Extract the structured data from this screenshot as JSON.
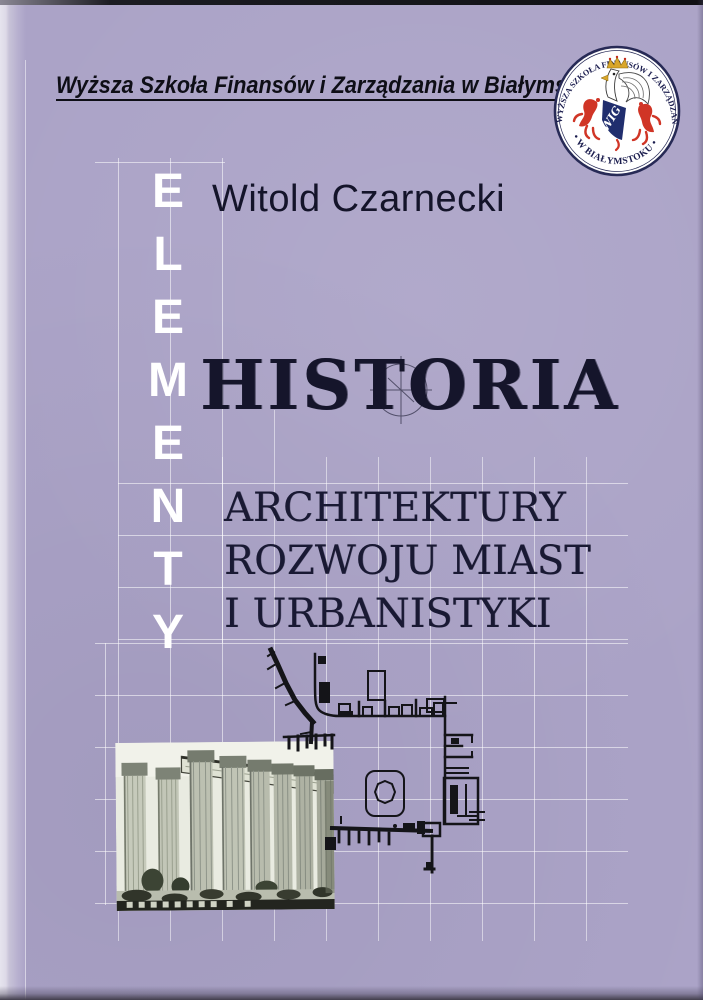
{
  "cover": {
    "publisher": "Wyższa Szkoła Finansów i Zarządzania w Białymstoku",
    "author": "Witold Czarnecki",
    "vertical_word": {
      "word": "ELEMENTY",
      "letters": [
        "E",
        "L",
        "E",
        "M",
        "E",
        "N",
        "T",
        "Y"
      ]
    },
    "title": "HISTORIA",
    "subtitle_lines": [
      "ARCHITEKTURY",
      "ROZWOJU MIAST",
      "I URBANISTYKI"
    ],
    "logo": {
      "ring_text_top": "WYŻSZA SZKOŁA FINANSÓW I ZARZĄDZANIA",
      "ring_text_bottom": "• W BIAŁYMSTOKU •",
      "monogram": "WIG"
    },
    "images": {
      "columns_photo": "temple-of-zeus-columns-photo",
      "plan_drawing": "ancient-city-plan-drawing"
    },
    "colors": {
      "background": "#aba3c7",
      "grid_line": "#ffffff",
      "title_text": "#15152b",
      "vertical_word_text": "#ffffff",
      "logo_red": "#d03526",
      "logo_navy": "#202e6e",
      "logo_gold": "#d9a62a"
    }
  }
}
